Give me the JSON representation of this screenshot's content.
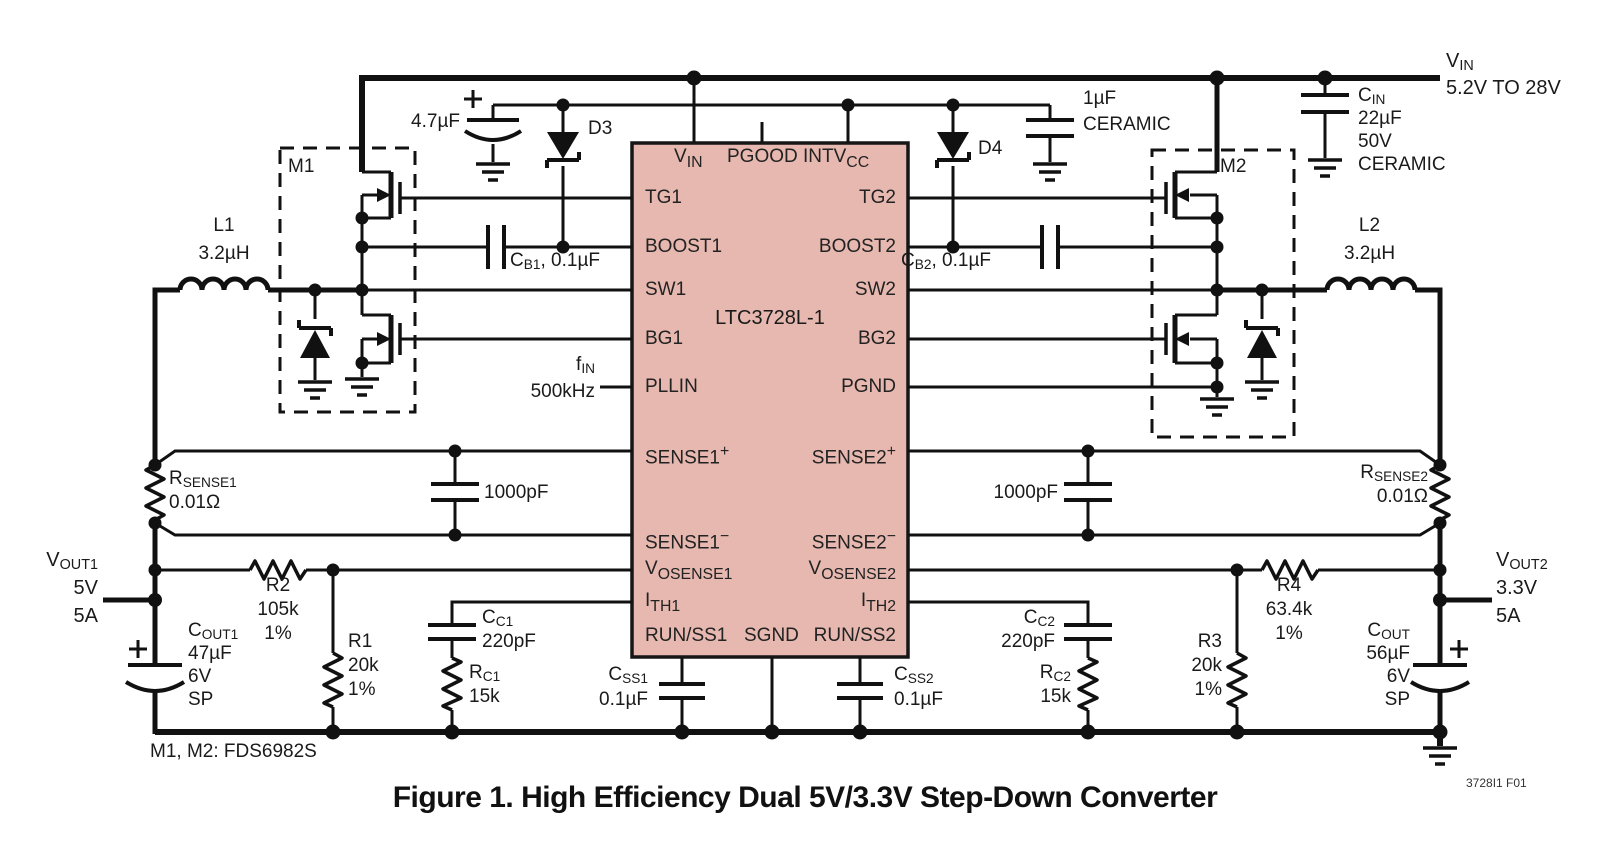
{
  "title": "Figure 1. High Efficiency Dual 5V/3.3V Step-Down Converter",
  "note": "M1, M2: FDS6982S",
  "fig_code": "3728I1 F01",
  "supply": {
    "pre": "V",
    "sub": "IN",
    "range": "5.2V TO 28V"
  },
  "ic": {
    "name": "LTC3728L-1",
    "pins": {
      "vin": {
        "pre": "V",
        "sub": "IN"
      },
      "pgood": "PGOOD",
      "intvcc": {
        "pre": "INTV",
        "sub": "CC"
      },
      "tg1": "TG1",
      "boost1": "BOOST1",
      "sw1": "SW1",
      "bg1": "BG1",
      "pllin": "PLLIN",
      "sense1p": {
        "pre": "SENSE1",
        "sup": "+"
      },
      "sense1m": {
        "pre": "SENSE1",
        "sup": "−"
      },
      "vosense1": {
        "pre": "V",
        "sub": "OSENSE1"
      },
      "ith1": {
        "pre": "I",
        "sub": "TH1"
      },
      "runss1": "RUN/SS1",
      "sgnd": "SGND",
      "runss2": "RUN/SS2",
      "tg2": "TG2",
      "boost2": "BOOST2",
      "sw2": "SW2",
      "bg2": "BG2",
      "pgnd": "PGND",
      "sense2p": {
        "pre": "SENSE2",
        "sup": "+"
      },
      "sense2m": {
        "pre": "SENSE2",
        "sup": "−"
      },
      "vosense2": {
        "pre": "V",
        "sub": "OSENSE2"
      },
      "ith2": {
        "pre": "I",
        "sub": "TH2"
      }
    }
  },
  "components": {
    "cin": {
      "pre": "C",
      "sub": "IN",
      "value": "22µF",
      "voltage": "50V",
      "type": "CERAMIC"
    },
    "c_intvcc": {
      "value": "1µF",
      "type": "CERAMIC"
    },
    "c_4u7": {
      "value": "4.7µF"
    },
    "d3": "D3",
    "d4": "D4",
    "m1": "M1",
    "m2": "M2",
    "cb1": {
      "pre": "C",
      "sub": "B1",
      "rest": ", 0.1µF"
    },
    "cb2": {
      "pre": "C",
      "sub": "B2",
      "rest": ", 0.1µF"
    },
    "l1": {
      "name": "L1",
      "value": "3.2µH"
    },
    "l2": {
      "name": "L2",
      "value": "3.2µH"
    },
    "fin": {
      "pre": "f",
      "sub": "IN",
      "value": "500kHz"
    },
    "rsense1": {
      "pre": "R",
      "sub": "SENSE1",
      "value": "0.01Ω"
    },
    "rsense2": {
      "pre": "R",
      "sub": "SENSE2",
      "value": "0.01Ω"
    },
    "cf1": {
      "value": "1000pF"
    },
    "cf2": {
      "value": "1000pF"
    },
    "vout1": {
      "pre": "V",
      "sub": "OUT1",
      "voltage": "5V",
      "current": "5A"
    },
    "vout2": {
      "pre": "V",
      "sub": "OUT2",
      "voltage": "3.3V",
      "current": "5A"
    },
    "r1": {
      "name": "R1",
      "value": "20k",
      "tol": "1%"
    },
    "r2": {
      "name": "R2",
      "value": "105k",
      "tol": "1%"
    },
    "r3": {
      "name": "R3",
      "value": "20k",
      "tol": "1%"
    },
    "r4": {
      "name": "R4",
      "value": "63.4k",
      "tol": "1%"
    },
    "cout1": {
      "pre": "C",
      "sub": "OUT1",
      "value": "47µF",
      "voltage": "6V",
      "type": "SP"
    },
    "cout2": {
      "pre": "C",
      "sub": "OUT",
      "value": "56µF",
      "voltage": "6V",
      "type": "SP"
    },
    "cc1": {
      "pre": "C",
      "sub": "C1",
      "value": "220pF"
    },
    "cc2": {
      "pre": "C",
      "sub": "C2",
      "value": "220pF"
    },
    "rc1": {
      "pre": "R",
      "sub": "C1",
      "value": "15k"
    },
    "rc2": {
      "pre": "R",
      "sub": "C2",
      "value": "15k"
    },
    "css1": {
      "pre": "C",
      "sub": "SS1",
      "value": "0.1µF"
    },
    "css2": {
      "pre": "C",
      "sub": "SS2",
      "value": "0.1µF"
    }
  }
}
